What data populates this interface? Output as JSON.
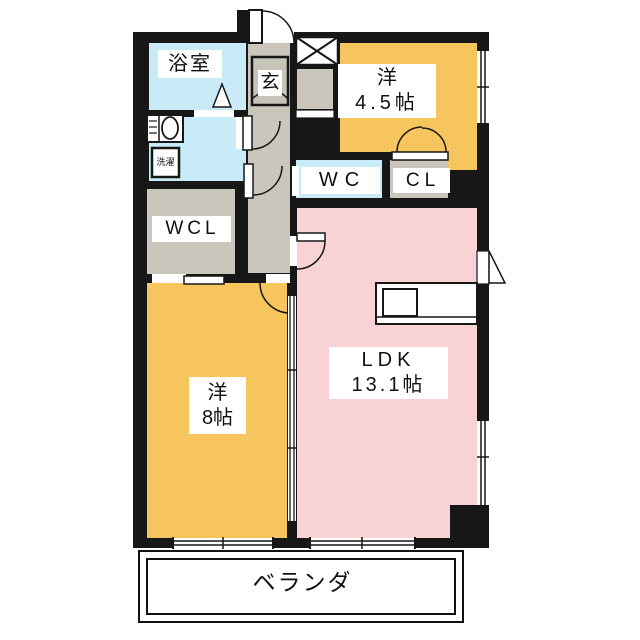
{
  "floorplan": {
    "title": "apartment-floor-plan",
    "rooms": {
      "bathroom": "浴室",
      "laundry": "洗濯",
      "entrance": "玄",
      "room45_name": "洋",
      "room45_size": "4.5帖",
      "wc": "WC",
      "cl": "CL",
      "wcl": "WCL",
      "room8_name": "洋",
      "room8_size": "8帖",
      "ldk_name": "LDK",
      "ldk_size": "13.1帖",
      "veranda": "ベランダ"
    },
    "colors": {
      "room-orange": "#f7c55e",
      "ldk-pink": "#f9d2d5",
      "wet-blue": "#c9ebf7",
      "hall-gray": "#cac6bb",
      "genkan-gray": "#c6c3b9",
      "wall-black": "#171717"
    }
  }
}
